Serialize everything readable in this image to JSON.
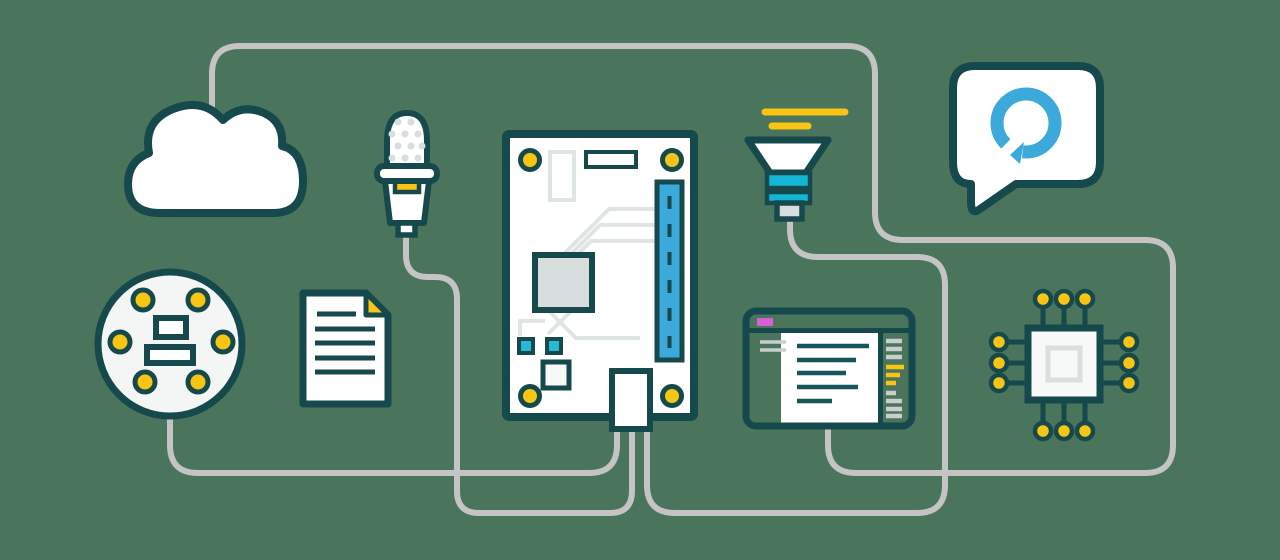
{
  "palette": {
    "background": "#4A745C",
    "outline_teal": "#16494C",
    "wire_gray": "#C4C4C4",
    "accent_yellow": "#F9C513",
    "accent_blue": "#3CA9DB",
    "accent_cyan": "#12B7D6",
    "accent_magenta": "#D361D3",
    "trace_light_gray": "#DFE4E4",
    "chip_gray": "#D7DCDC",
    "panel_white": "#FFFFFF"
  },
  "diagram": {
    "type": "iot-voice-assistant-illustration",
    "nodes": [
      {
        "id": "cloud-icon",
        "kind": "cloud"
      },
      {
        "id": "microphone-icon",
        "kind": "microphone"
      },
      {
        "id": "mic-array-disc-icon",
        "kind": "circular-mic-array-board"
      },
      {
        "id": "document-icon",
        "kind": "document"
      },
      {
        "id": "circuit-board-icon",
        "kind": "dev-board-with-gpio-header"
      },
      {
        "id": "speaker-horn-icon",
        "kind": "speaker-horn"
      },
      {
        "id": "code-editor-window-icon",
        "kind": "code-editor-window"
      },
      {
        "id": "alexa-speech-bubble-icon",
        "kind": "speech-bubble-with-alexa-logo"
      },
      {
        "id": "cpu-chip-icon",
        "kind": "cpu-chip"
      }
    ],
    "connections": [
      {
        "from": "cloud-icon",
        "to": "code-editor-window-icon",
        "style": "gray-wire"
      },
      {
        "from": "microphone-icon",
        "to": "circuit-board-icon",
        "style": "gray-wire"
      },
      {
        "from": "mic-array-disc-icon",
        "to": "circuit-board-icon",
        "style": "gray-wire"
      },
      {
        "from": "speaker-horn-icon",
        "to": "circuit-board-icon",
        "style": "gray-wire"
      }
    ]
  }
}
